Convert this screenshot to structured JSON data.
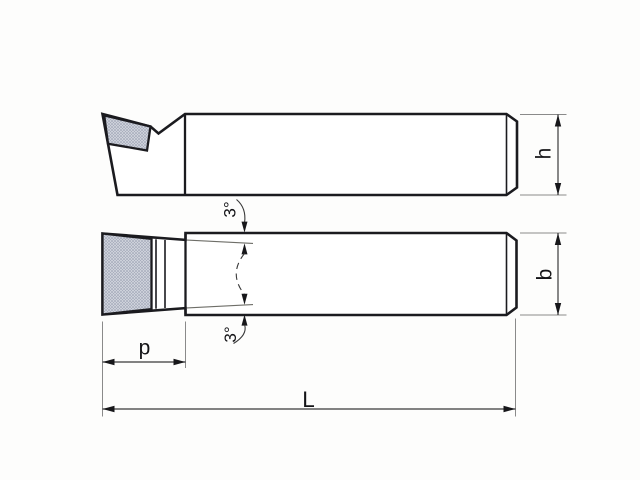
{
  "drawing": {
    "labels": {
      "height": "h",
      "width": "b",
      "insert_length": "p",
      "overall_length": "L",
      "taper_angle_top": "3°",
      "taper_angle_bottom": "3°"
    },
    "colors": {
      "outline": "#1b1b1f",
      "dimension_lines": "#3a3a3a",
      "extension_lines": "#8a8a8a",
      "insert_fill": "#cdd1da",
      "insert_dots": "#8f95a8",
      "background": "#fdfdfc"
    }
  }
}
